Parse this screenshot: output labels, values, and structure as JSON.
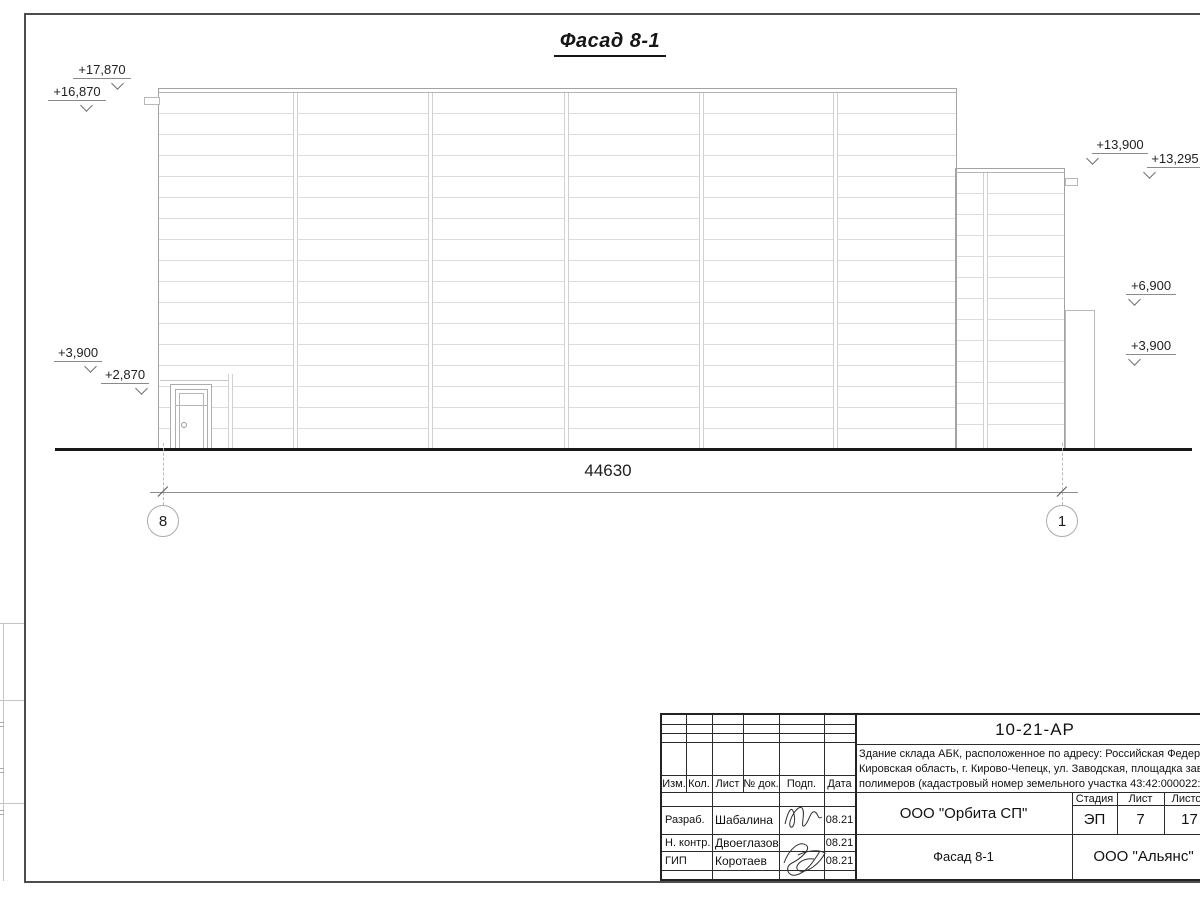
{
  "drawing": {
    "title": "Фасад 8-1",
    "levels": {
      "a": "+17,870",
      "b": "+16,870",
      "c": "+3,900",
      "d": "+2,870",
      "e": "+13,900",
      "f": "+13,295",
      "g": "+6,900",
      "h": "+3,900"
    },
    "dimension_total": "44630",
    "axis_left": "8",
    "axis_right": "1"
  },
  "stamp": {
    "doc_number": "10-21-АР",
    "description": {
      "line1": "Здание склада АБК, расположенное по адресу: Российская Федерац",
      "line2": "Кировская область, г. Кирово-Чепецк, ул. Заводская, площадка заво",
      "line3": "полимеров (кадастровый номер земельного участка 43:42:000022:"
    },
    "columns": {
      "izm": "Изм.",
      "kol": "Кол.",
      "list": "Лист",
      "doc": "№ док.",
      "podp": "Подп.",
      "data": "Дата"
    },
    "rows": [
      {
        "role": "Разраб.",
        "name": "Шабалина",
        "date": "08.21"
      },
      {
        "role": "Н. контр.",
        "name": "Двоеглазов",
        "date": "08.21"
      },
      {
        "role": "ГИП",
        "name": "Коротаев",
        "date": "08.21"
      }
    ],
    "org": "ООО \"Орбита СП\"",
    "drawing_name": "Фасад 8-1",
    "company": "ООО \"Альянс\"",
    "stage_label": "Стадия",
    "sheet_label": "Лист",
    "sheets_label": "Листов",
    "stage": "ЭП",
    "sheet_no": "7",
    "sheets_total": "17"
  }
}
